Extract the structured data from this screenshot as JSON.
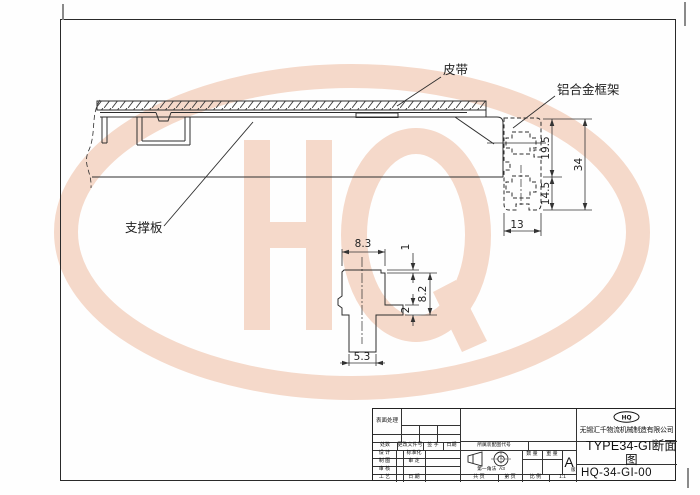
{
  "watermark": {
    "letters": "HQ",
    "color": "#f5d9ca"
  },
  "drawing": {
    "labels": {
      "belt": "皮带",
      "frame": "铝合金框架",
      "support": "支撑板"
    },
    "dims": {
      "h195": "19.5",
      "h34": "34",
      "h145": "14.5",
      "w13": "13",
      "w83": "8.3",
      "d1": "1",
      "d82": "8.2",
      "d2": "2",
      "w53": "5.3"
    }
  },
  "title_block": {
    "surface": "表面处理",
    "rev_cols": [
      "处数",
      "更改文件号",
      "签 字",
      "日期"
    ],
    "left_rows": [
      "设 计",
      "制 图",
      "审 核",
      "工 艺"
    ],
    "mid_rows": [
      "标准化",
      "审 定",
      "日 期"
    ],
    "assembly": "所属装配图代号",
    "projection": "第一角法",
    "paper": "A3",
    "qty": "数 量",
    "weight": "重 量",
    "rev_letter": "A",
    "rev_suffix": "版",
    "pages_total": "共    页",
    "pages_no": "第    页",
    "scale_label": "比 例",
    "scale_value": "1:1",
    "logo": "HQ",
    "company": "无锡汇千物流机械制造有限公司",
    "title": "TYPE34-GI断面图",
    "number": "HQ-34-GI-00"
  }
}
